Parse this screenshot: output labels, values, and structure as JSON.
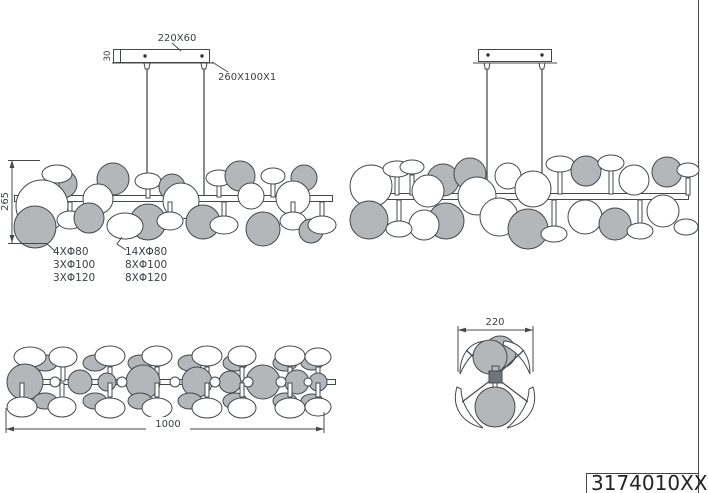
{
  "title_block": {
    "part_number": "3174010XX"
  },
  "dimensions": {
    "canopy_size": "220X60",
    "canopy_height": "30",
    "plate_size": "260X100X1",
    "fixture_height": "265",
    "fixture_length": "1000",
    "fixture_depth": "220"
  },
  "disc_notes": {
    "left": [
      "4XΦ80",
      "3XΦ100",
      "3XΦ120"
    ],
    "right": [
      "14XΦ80",
      "8XΦ100",
      "8XΦ120"
    ]
  },
  "colors": {
    "disc_gray": "#b3b7b9",
    "disc_white": "#ffffff",
    "hub_dark": "#6e7477",
    "line": "#44484b"
  },
  "views": {
    "front": {
      "shapes": [
        {
          "t": "c",
          "x": 63,
          "y": 184,
          "r": 14,
          "f": "g"
        },
        {
          "t": "s",
          "x1": 57,
          "y1": 183,
          "x2": 57,
          "y2": 197
        },
        {
          "t": "e",
          "x": 57,
          "y": 174,
          "rx": 15,
          "ry": 9,
          "f": "w"
        },
        {
          "t": "c",
          "x": 113,
          "y": 179,
          "r": 16,
          "f": "g"
        },
        {
          "t": "c",
          "x": 42,
          "y": 206,
          "r": 26,
          "f": "w"
        },
        {
          "t": "c",
          "x": 98,
          "y": 199,
          "r": 15,
          "f": "w"
        },
        {
          "t": "s",
          "x1": 148,
          "y1": 188,
          "x2": 148,
          "y2": 198
        },
        {
          "t": "e",
          "x": 148,
          "y": 181,
          "rx": 13,
          "ry": 8,
          "f": "w"
        },
        {
          "t": "c",
          "x": 172,
          "y": 187,
          "r": 13,
          "f": "g"
        },
        {
          "t": "c",
          "x": 181,
          "y": 201,
          "r": 18,
          "f": "w"
        },
        {
          "t": "s",
          "x1": 219,
          "y1": 184,
          "x2": 219,
          "y2": 197
        },
        {
          "t": "e",
          "x": 219,
          "y": 178,
          "rx": 13,
          "ry": 8,
          "f": "w"
        },
        {
          "t": "c",
          "x": 240,
          "y": 176,
          "r": 15,
          "f": "g"
        },
        {
          "t": "c",
          "x": 251,
          "y": 196,
          "r": 13,
          "f": "w"
        },
        {
          "t": "s",
          "x1": 273,
          "y1": 182,
          "x2": 273,
          "y2": 197
        },
        {
          "t": "e",
          "x": 273,
          "y": 176,
          "rx": 12,
          "ry": 8,
          "f": "w"
        },
        {
          "t": "c",
          "x": 304,
          "y": 178,
          "r": 13,
          "f": "g"
        },
        {
          "t": "c",
          "x": 293,
          "y": 198,
          "r": 17,
          "f": "w"
        },
        {
          "t": "c",
          "x": 35,
          "y": 227,
          "r": 21,
          "f": "g"
        },
        {
          "t": "s",
          "x1": 70,
          "y1": 202,
          "x2": 70,
          "y2": 212
        },
        {
          "t": "e",
          "x": 70,
          "y": 220,
          "rx": 13,
          "ry": 9,
          "f": "w"
        },
        {
          "t": "c",
          "x": 89,
          "y": 218,
          "r": 15,
          "f": "g"
        },
        {
          "t": "c",
          "x": 148,
          "y": 222,
          "r": 18,
          "f": "g"
        },
        {
          "t": "e",
          "x": 125,
          "y": 226,
          "rx": 18,
          "ry": 13,
          "f": "w"
        },
        {
          "t": "s",
          "x1": 170,
          "y1": 202,
          "x2": 170,
          "y2": 213
        },
        {
          "t": "e",
          "x": 170,
          "y": 221,
          "rx": 13,
          "ry": 9,
          "f": "w"
        },
        {
          "t": "c",
          "x": 203,
          "y": 222,
          "r": 17,
          "f": "g"
        },
        {
          "t": "s",
          "x1": 224,
          "y1": 202,
          "x2": 224,
          "y2": 217
        },
        {
          "t": "e",
          "x": 224,
          "y": 225,
          "rx": 14,
          "ry": 9,
          "f": "w"
        },
        {
          "t": "c",
          "x": 263,
          "y": 229,
          "r": 17,
          "f": "g"
        },
        {
          "t": "s",
          "x1": 293,
          "y1": 202,
          "x2": 293,
          "y2": 213
        },
        {
          "t": "e",
          "x": 293,
          "y": 221,
          "rx": 13,
          "ry": 9,
          "f": "w"
        },
        {
          "t": "c",
          "x": 311,
          "y": 231,
          "r": 12,
          "f": "g"
        },
        {
          "t": "s",
          "x1": 322,
          "y1": 202,
          "x2": 322,
          "y2": 216
        },
        {
          "t": "e",
          "x": 322,
          "y": 225,
          "rx": 14,
          "ry": 9,
          "f": "w"
        }
      ]
    },
    "perspective": {
      "shapes": [
        {
          "t": "c",
          "x": 371,
          "y": 186,
          "r": 21,
          "f": "w"
        },
        {
          "t": "c",
          "x": 369,
          "y": 220,
          "r": 19,
          "f": "g"
        },
        {
          "t": "s",
          "x1": 397,
          "y1": 177,
          "x2": 397,
          "y2": 195
        },
        {
          "t": "e",
          "x": 397,
          "y": 169,
          "rx": 14,
          "ry": 8,
          "f": "w"
        },
        {
          "t": "s",
          "x1": 412,
          "y1": 175,
          "x2": 412,
          "y2": 195
        },
        {
          "t": "e",
          "x": 412,
          "y": 167,
          "rx": 12,
          "ry": 7,
          "f": "w"
        },
        {
          "t": "c",
          "x": 443,
          "y": 180,
          "r": 16,
          "f": "g"
        },
        {
          "t": "c",
          "x": 428,
          "y": 191,
          "r": 16,
          "f": "w"
        },
        {
          "t": "c",
          "x": 470,
          "y": 174,
          "r": 16,
          "f": "g"
        },
        {
          "t": "c",
          "x": 477,
          "y": 196,
          "r": 19,
          "f": "w"
        },
        {
          "t": "c",
          "x": 508,
          "y": 176,
          "r": 13,
          "f": "w"
        },
        {
          "t": "s",
          "x1": 560,
          "y1": 172,
          "x2": 560,
          "y2": 194
        },
        {
          "t": "e",
          "x": 560,
          "y": 164,
          "rx": 14,
          "ry": 8,
          "f": "w"
        },
        {
          "t": "c",
          "x": 533,
          "y": 189,
          "r": 18,
          "f": "w"
        },
        {
          "t": "c",
          "x": 586,
          "y": 171,
          "r": 15,
          "f": "g"
        },
        {
          "t": "s",
          "x1": 611,
          "y1": 171,
          "x2": 611,
          "y2": 194
        },
        {
          "t": "e",
          "x": 611,
          "y": 163,
          "rx": 13,
          "ry": 8,
          "f": "w"
        },
        {
          "t": "c",
          "x": 634,
          "y": 180,
          "r": 15,
          "f": "w"
        },
        {
          "t": "c",
          "x": 667,
          "y": 172,
          "r": 15,
          "f": "g"
        },
        {
          "t": "s",
          "x1": 688,
          "y1": 178,
          "x2": 688,
          "y2": 195
        },
        {
          "t": "e",
          "x": 688,
          "y": 170,
          "rx": 11,
          "ry": 7,
          "f": "w"
        },
        {
          "t": "c",
          "x": 446,
          "y": 221,
          "r": 18,
          "f": "g"
        },
        {
          "t": "c",
          "x": 424,
          "y": 225,
          "r": 15,
          "f": "w"
        },
        {
          "t": "s",
          "x1": 399,
          "y1": 200,
          "x2": 399,
          "y2": 221
        },
        {
          "t": "e",
          "x": 399,
          "y": 229,
          "rx": 13,
          "ry": 8,
          "f": "w"
        },
        {
          "t": "c",
          "x": 499,
          "y": 217,
          "r": 19,
          "f": "w"
        },
        {
          "t": "c",
          "x": 528,
          "y": 229,
          "r": 20,
          "f": "g"
        },
        {
          "t": "s",
          "x1": 554,
          "y1": 200,
          "x2": 554,
          "y2": 227
        },
        {
          "t": "e",
          "x": 554,
          "y": 234,
          "rx": 13,
          "ry": 8,
          "f": "w"
        },
        {
          "t": "c",
          "x": 585,
          "y": 217,
          "r": 17,
          "f": "w"
        },
        {
          "t": "c",
          "x": 615,
          "y": 224,
          "r": 16,
          "f": "g"
        },
        {
          "t": "s",
          "x1": 640,
          "y1": 200,
          "x2": 640,
          "y2": 225
        },
        {
          "t": "e",
          "x": 640,
          "y": 231,
          "rx": 13,
          "ry": 8,
          "f": "w"
        },
        {
          "t": "c",
          "x": 663,
          "y": 211,
          "r": 16,
          "f": "w"
        },
        {
          "t": "e",
          "x": 686,
          "y": 227,
          "rx": 12,
          "ry": 8,
          "f": "w"
        }
      ]
    },
    "top": {
      "shapes": [
        {
          "t": "e",
          "x": 45,
          "y": 363,
          "rx": 12,
          "ry": 8,
          "f": "g"
        },
        {
          "t": "e",
          "x": 95,
          "y": 363,
          "rx": 12,
          "ry": 8,
          "f": "g"
        },
        {
          "t": "e",
          "x": 140,
          "y": 363,
          "rx": 12,
          "ry": 8,
          "f": "g"
        },
        {
          "t": "e",
          "x": 190,
          "y": 363,
          "rx": 12,
          "ry": 8,
          "f": "g"
        },
        {
          "t": "e",
          "x": 235,
          "y": 363,
          "rx": 12,
          "ry": 8,
          "f": "g"
        },
        {
          "t": "e",
          "x": 285,
          "y": 363,
          "rx": 12,
          "ry": 8,
          "f": "g"
        },
        {
          "t": "e",
          "x": 312,
          "y": 363,
          "rx": 11,
          "ry": 7,
          "f": "g"
        },
        {
          "t": "s",
          "x1": 30,
          "y1": 367,
          "x2": 30,
          "y2": 381
        },
        {
          "t": "s",
          "x1": 63,
          "y1": 367,
          "x2": 63,
          "y2": 381
        },
        {
          "t": "s",
          "x1": 110,
          "y1": 367,
          "x2": 110,
          "y2": 381
        },
        {
          "t": "s",
          "x1": 157,
          "y1": 367,
          "x2": 157,
          "y2": 381
        },
        {
          "t": "s",
          "x1": 207,
          "y1": 367,
          "x2": 207,
          "y2": 381
        },
        {
          "t": "s",
          "x1": 242,
          "y1": 367,
          "x2": 242,
          "y2": 381
        },
        {
          "t": "s",
          "x1": 290,
          "y1": 367,
          "x2": 290,
          "y2": 381
        },
        {
          "t": "s",
          "x1": 318,
          "y1": 367,
          "x2": 318,
          "y2": 381
        },
        {
          "t": "e",
          "x": 30,
          "y": 357,
          "rx": 16,
          "ry": 10,
          "f": "w"
        },
        {
          "t": "e",
          "x": 63,
          "y": 357,
          "rx": 14,
          "ry": 10,
          "f": "w"
        },
        {
          "t": "e",
          "x": 110,
          "y": 356,
          "rx": 15,
          "ry": 10,
          "f": "w"
        },
        {
          "t": "e",
          "x": 157,
          "y": 356,
          "rx": 15,
          "ry": 10,
          "f": "w"
        },
        {
          "t": "e",
          "x": 207,
          "y": 356,
          "rx": 15,
          "ry": 10,
          "f": "w"
        },
        {
          "t": "e",
          "x": 242,
          "y": 356,
          "rx": 14,
          "ry": 10,
          "f": "w"
        },
        {
          "t": "e",
          "x": 290,
          "y": 356,
          "rx": 15,
          "ry": 10,
          "f": "w"
        },
        {
          "t": "e",
          "x": 318,
          "y": 357,
          "rx": 13,
          "ry": 9,
          "f": "w"
        },
        {
          "t": "c",
          "x": 25,
          "y": 382,
          "r": 18,
          "f": "g"
        },
        {
          "t": "c",
          "x": 80,
          "y": 382,
          "r": 12,
          "f": "g"
        },
        {
          "t": "c",
          "x": 107,
          "y": 382,
          "r": 9,
          "f": "g"
        },
        {
          "t": "c",
          "x": 143,
          "y": 382,
          "r": 17,
          "f": "g"
        },
        {
          "t": "c",
          "x": 197,
          "y": 382,
          "r": 15,
          "f": "g"
        },
        {
          "t": "c",
          "x": 230,
          "y": 382,
          "r": 11,
          "f": "g"
        },
        {
          "t": "c",
          "x": 263,
          "y": 382,
          "r": 17,
          "f": "g"
        },
        {
          "t": "c",
          "x": 297,
          "y": 382,
          "r": 12,
          "f": "g"
        },
        {
          "t": "c",
          "x": 318,
          "y": 382,
          "r": 9,
          "f": "g"
        },
        {
          "t": "c",
          "x": 55,
          "y": 382,
          "r": 5,
          "f": "w"
        },
        {
          "t": "c",
          "x": 122,
          "y": 382,
          "r": 5,
          "f": "w"
        },
        {
          "t": "c",
          "x": 175,
          "y": 382,
          "r": 5,
          "f": "w"
        },
        {
          "t": "c",
          "x": 215,
          "y": 382,
          "r": 5,
          "f": "w"
        },
        {
          "t": "c",
          "x": 248,
          "y": 382,
          "r": 5,
          "f": "w"
        },
        {
          "t": "c",
          "x": 281,
          "y": 382,
          "r": 5,
          "f": "w"
        },
        {
          "t": "c",
          "x": 308,
          "y": 382,
          "r": 4,
          "f": "w"
        },
        {
          "t": "e",
          "x": 45,
          "y": 401,
          "rx": 12,
          "ry": 8,
          "f": "g"
        },
        {
          "t": "e",
          "x": 95,
          "y": 401,
          "rx": 12,
          "ry": 8,
          "f": "g"
        },
        {
          "t": "e",
          "x": 140,
          "y": 401,
          "rx": 12,
          "ry": 8,
          "f": "g"
        },
        {
          "t": "e",
          "x": 190,
          "y": 401,
          "rx": 12,
          "ry": 8,
          "f": "g"
        },
        {
          "t": "e",
          "x": 235,
          "y": 401,
          "rx": 12,
          "ry": 8,
          "f": "g"
        },
        {
          "t": "e",
          "x": 285,
          "y": 401,
          "rx": 12,
          "ry": 8,
          "f": "g"
        },
        {
          "t": "e",
          "x": 312,
          "y": 401,
          "rx": 11,
          "ry": 7,
          "f": "g"
        },
        {
          "t": "s",
          "x1": 22,
          "y1": 383,
          "x2": 22,
          "y2": 397
        },
        {
          "t": "s",
          "x1": 62,
          "y1": 383,
          "x2": 62,
          "y2": 397
        },
        {
          "t": "s",
          "x1": 110,
          "y1": 383,
          "x2": 110,
          "y2": 397
        },
        {
          "t": "s",
          "x1": 157,
          "y1": 383,
          "x2": 157,
          "y2": 397
        },
        {
          "t": "s",
          "x1": 207,
          "y1": 383,
          "x2": 207,
          "y2": 397
        },
        {
          "t": "s",
          "x1": 242,
          "y1": 383,
          "x2": 242,
          "y2": 397
        },
        {
          "t": "s",
          "x1": 290,
          "y1": 383,
          "x2": 290,
          "y2": 397
        },
        {
          "t": "s",
          "x1": 318,
          "y1": 383,
          "x2": 318,
          "y2": 397
        },
        {
          "t": "e",
          "x": 22,
          "y": 407,
          "rx": 15,
          "ry": 10,
          "f": "w"
        },
        {
          "t": "e",
          "x": 62,
          "y": 407,
          "rx": 14,
          "ry": 10,
          "f": "w"
        },
        {
          "t": "e",
          "x": 110,
          "y": 408,
          "rx": 15,
          "ry": 10,
          "f": "w"
        },
        {
          "t": "e",
          "x": 157,
          "y": 408,
          "rx": 15,
          "ry": 10,
          "f": "w"
        },
        {
          "t": "e",
          "x": 207,
          "y": 408,
          "rx": 15,
          "ry": 10,
          "f": "w"
        },
        {
          "t": "e",
          "x": 242,
          "y": 408,
          "rx": 14,
          "ry": 10,
          "f": "w"
        },
        {
          "t": "e",
          "x": 290,
          "y": 408,
          "rx": 15,
          "ry": 10,
          "f": "w"
        },
        {
          "t": "e",
          "x": 318,
          "y": 407,
          "rx": 13,
          "ry": 9,
          "f": "w"
        }
      ]
    },
    "end": {
      "shapes": [
        {
          "t": "c",
          "x": 500,
          "y": 352,
          "r": 16,
          "f": "g"
        },
        {
          "t": "p",
          "d": "M486,341 C469,342 460,355 460,374 C466,360 475,350 487,345 Z",
          "f": "w",
          "n": "petal-upper-left"
        },
        {
          "t": "p",
          "d": "M504,341 C521,342 530,355 530,374 C524,360 515,350 503,345 Z",
          "f": "w",
          "n": "petal-upper-right"
        },
        {
          "t": "l",
          "x1": 466,
          "y1": 350,
          "x2": 495,
          "y2": 377
        },
        {
          "t": "l",
          "x1": 524,
          "y1": 350,
          "x2": 495,
          "y2": 377
        },
        {
          "t": "c",
          "x": 490,
          "y": 357,
          "r": 17,
          "f": "g"
        },
        {
          "t": "p",
          "d": "M457,387 C451,407 462,423 483,428 C470,417 461,403 461,389 Z",
          "f": "w",
          "n": "petal-lower-left"
        },
        {
          "t": "p",
          "d": "M533,387 C539,407 528,423 507,428 C520,417 529,403 529,389 Z",
          "f": "w",
          "n": "petal-lower-right"
        },
        {
          "t": "l",
          "x1": 462,
          "y1": 402,
          "x2": 495,
          "y2": 377
        },
        {
          "t": "l",
          "x1": 528,
          "y1": 402,
          "x2": 495,
          "y2": 377
        },
        {
          "t": "s",
          "x1": 495,
          "y1": 377,
          "x2": 495,
          "y2": 390
        },
        {
          "t": "c",
          "x": 495,
          "y": 407,
          "r": 20,
          "f": "g"
        },
        {
          "t": "p",
          "d": "M492,366 h7 v6 h-7 z",
          "f": "g",
          "n": "hub-neck"
        },
        {
          "t": "p",
          "d": "M489,371 h13 v12 h-13 z",
          "f": "d",
          "n": "hub"
        }
      ]
    }
  }
}
